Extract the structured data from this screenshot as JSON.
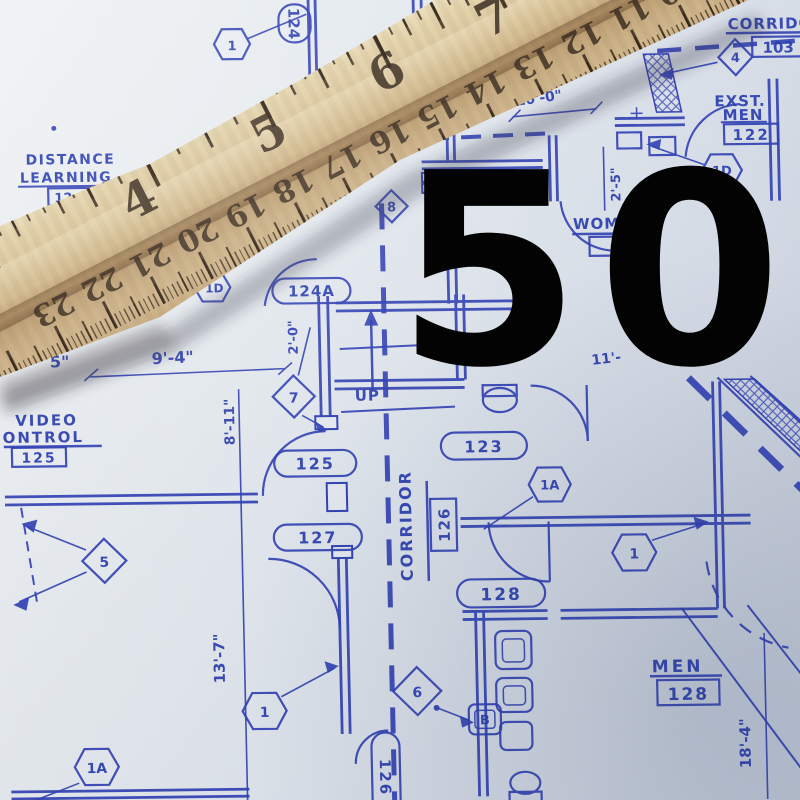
{
  "overlay": {
    "number": "50"
  },
  "colors": {
    "blueprint_ink": "#2236ae",
    "paper": "#e3e7ec",
    "wood": "#d8c193",
    "overlay_text": "#000000"
  },
  "ruler": {
    "inch_numbers": [
      {
        "label": "4",
        "x": 214
      },
      {
        "label": "5",
        "x": 360
      },
      {
        "label": "6",
        "x": 493
      },
      {
        "label": "7",
        "x": 613
      }
    ],
    "cm_numbers": [
      {
        "label": "23",
        "x": 70
      },
      {
        "label": "22",
        "x": 124
      },
      {
        "label": "21",
        "x": 178
      },
      {
        "label": "20",
        "x": 232
      },
      {
        "label": "19",
        "x": 286
      },
      {
        "label": "18",
        "x": 340
      },
      {
        "label": "17",
        "x": 394
      },
      {
        "label": "16",
        "x": 448
      },
      {
        "label": "15",
        "x": 502
      },
      {
        "label": "14",
        "x": 556
      },
      {
        "label": "13",
        "x": 610
      },
      {
        "label": "12",
        "x": 664
      },
      {
        "label": "11",
        "x": 718
      },
      {
        "label": "10",
        "x": 772
      }
    ]
  },
  "blueprint": {
    "labels": {
      "distance_line1": "DISTANCE",
      "distance_line2": "LEARNING",
      "distance_number": "12",
      "room_124": "124",
      "hex_1_top": "1",
      "corridor_top": "CORRIDOR",
      "corridor_top_number": "103",
      "diamond_4": "4",
      "exst": "EXST.",
      "exst_men": "MEN",
      "exst_men_number": "122",
      "hex_1d_right": "1D",
      "hex_1d_center": "1D",
      "hex_1d_left": "1D",
      "diamond_8": "8",
      "dim_10_0": "10'-0\"",
      "dim_2_5": "2'-5\"",
      "women_partial": "WOM",
      "dim_11": "11'-",
      "oval_124a": "124A",
      "room_123": "123",
      "hex_1a_center": "1A",
      "up": "UP",
      "diamond_7": "7",
      "dim_2_0": "2'-0\"",
      "dim_9_4": "9'-4\"",
      "dim_5in": "5\"",
      "video": "VIDEO",
      "control": "CONTROL",
      "video_control_number": "125",
      "dim_8_11": "8'-11\"",
      "oval_125": "125",
      "oval_127": "127",
      "diamond_5": "5",
      "dim_13_7": "13'-7\"",
      "hex_1a_bottom": "1A",
      "hex_1_bottomleft": "1",
      "corridor_main": "CORRIDOR",
      "corridor_main_number": "126",
      "oval_128": "128",
      "diamond_6": "6",
      "b_marker": "B",
      "oval_126_bottom": "126",
      "hex_1_right": "1",
      "men": "MEN",
      "men_number": "128",
      "dim_18_4": "18'-4\""
    }
  }
}
